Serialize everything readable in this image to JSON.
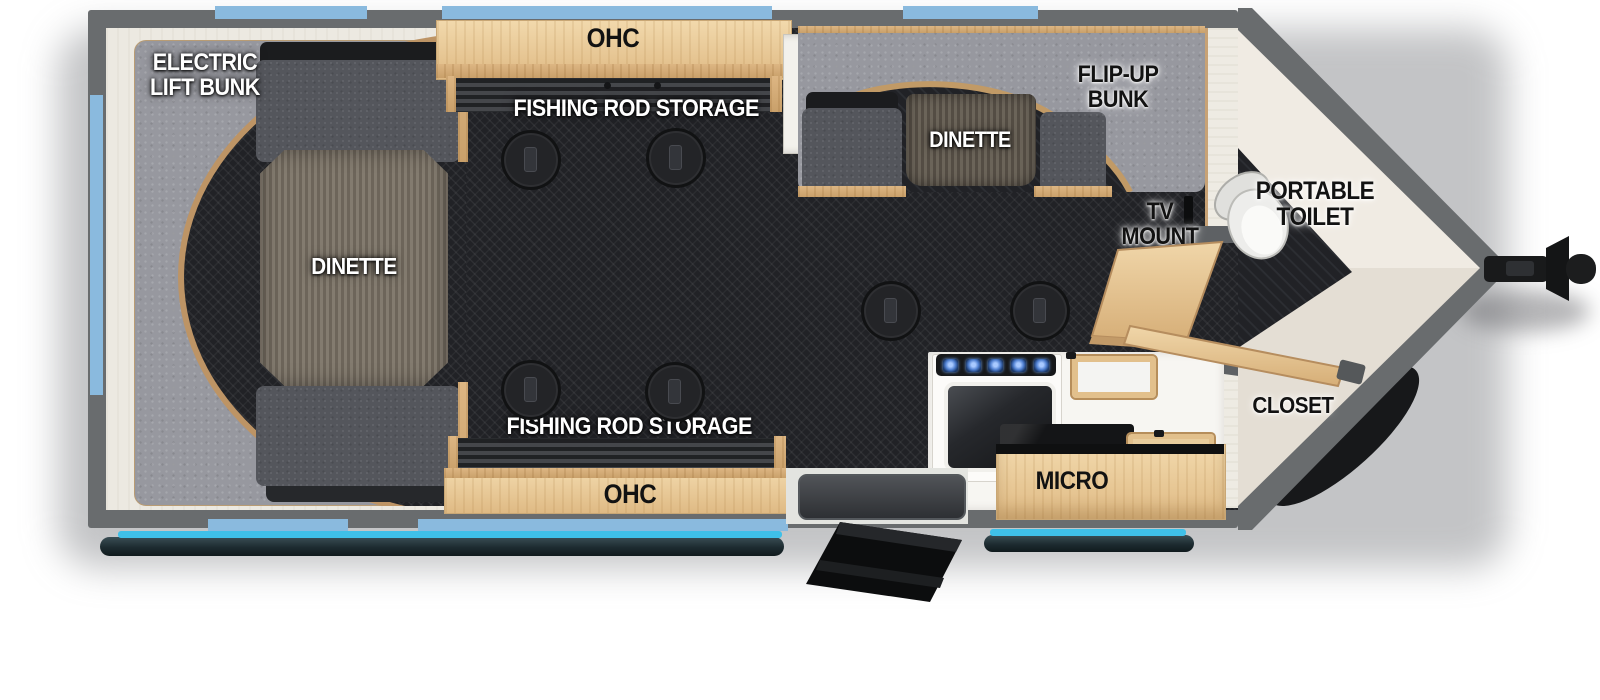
{
  "title": "Travel trailer floor plan (toy-hauler / fish house style)",
  "labels": {
    "electric_lift_bunk": [
      "ELECTRIC",
      "LIFT BUNK"
    ],
    "dinette_left": "DINETTE",
    "ohc_top": "OHC",
    "rod_storage_top": "FISHING ROD STORAGE",
    "flip_up_bunk": [
      "FLIP-UP",
      "BUNK"
    ],
    "dinette_right": "DINETTE",
    "tv_mount": [
      "TV",
      "MOUNT"
    ],
    "portable_toilet": [
      "PORTABLE",
      "TOILET"
    ],
    "closet": "CLOSET",
    "micro": "MICRO",
    "rod_storage_bottom": "FISHING ROD STORAGE",
    "ohc_bottom": "OHC"
  },
  "colors": {
    "wall_gray": "#696c6e",
    "floor_dark": "#212226",
    "interior_white": "#ece9e1",
    "nose_floor": "#f0ebe3",
    "wood": "#ead0a2",
    "wood_edge": "#bd9465",
    "cushion_gray": "#97989f",
    "sofa_dark": "#54565c",
    "sofa_black": "#1b1c1e",
    "window_blue": "#8abade",
    "awning_cyan": "#3fc0e8",
    "appliance_white": "#f7f6f2",
    "label_white": "#ffffff",
    "label_black": "#121212"
  },
  "features": [
    "electric lift bunk over dinette (rear)",
    "overhead cabinets with fishing rod storage (both sides of aisle)",
    "flip-up bunk over second dinette",
    "TV mount",
    "portable toilet in nose",
    "closet in nose",
    "range with microwave cabinet",
    "entry step (curb side)",
    "six floor table mounts",
    "awning (curb side)",
    "front hitch / V-nose"
  ]
}
